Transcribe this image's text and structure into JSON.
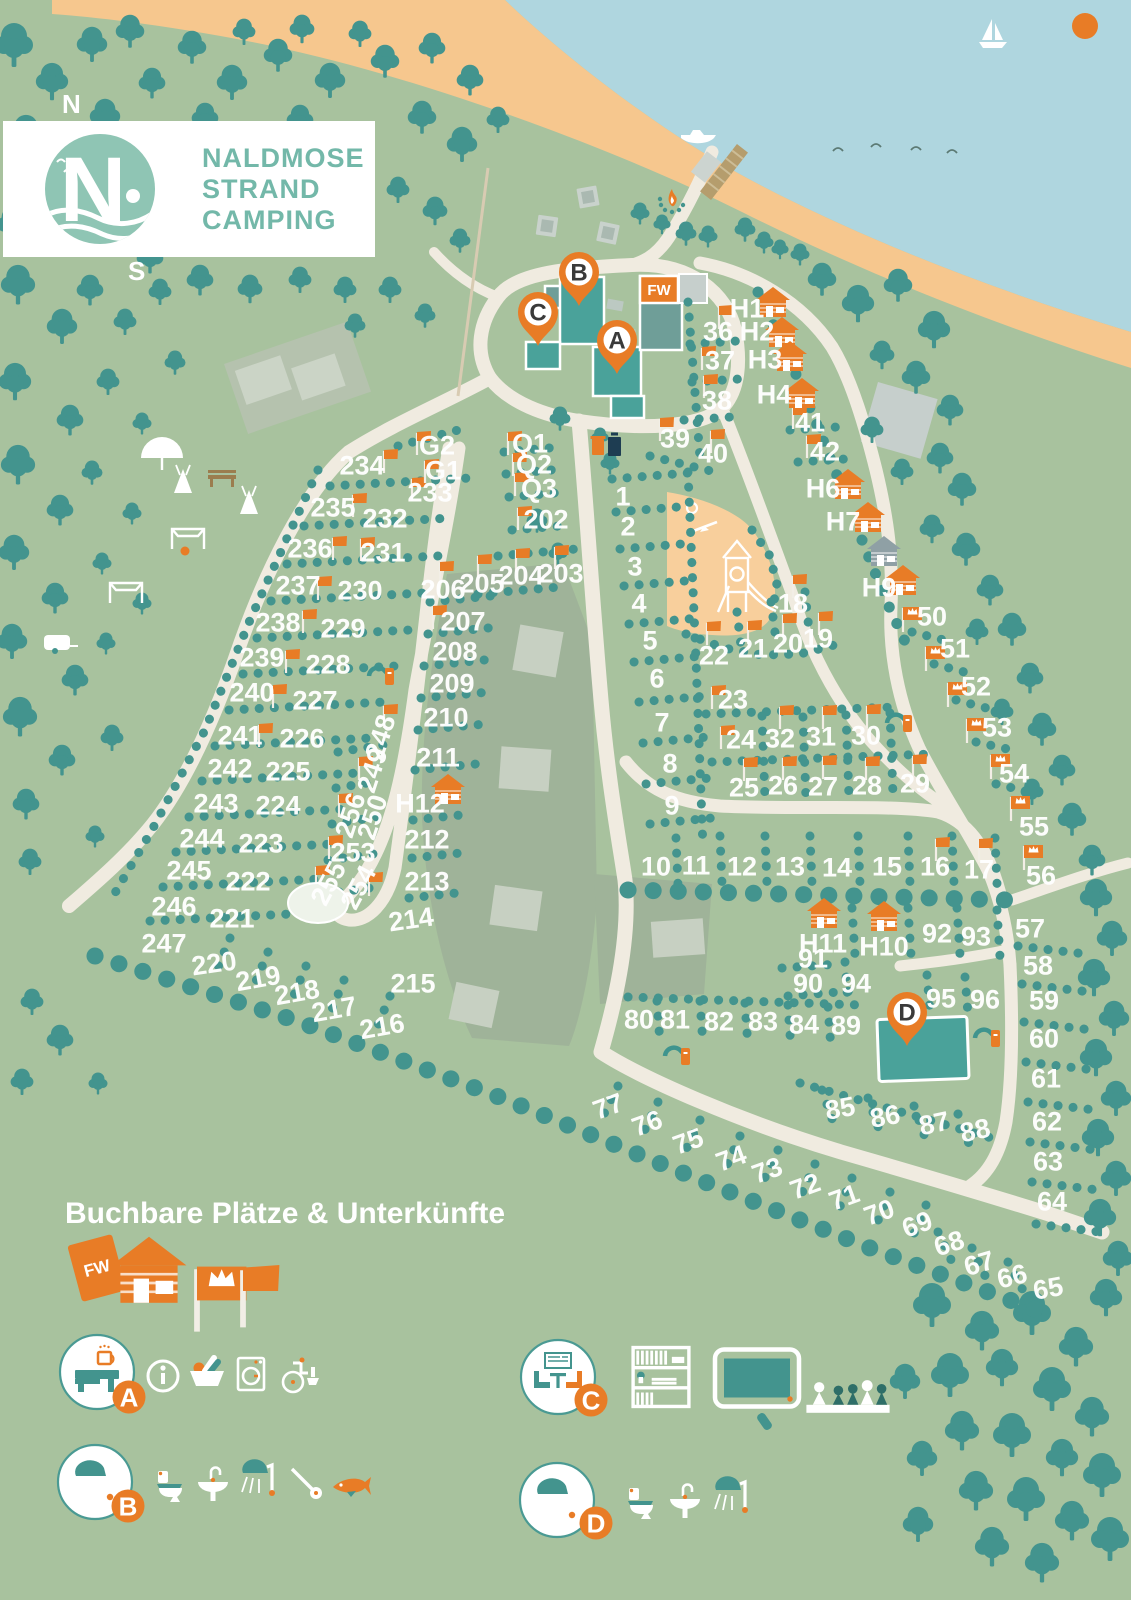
{
  "logo": {
    "initial": "N",
    "line1": "NALDMOSE",
    "line2": "STRAND",
    "line3": "CAMPING"
  },
  "compass": {
    "n": "N",
    "w": "W",
    "s": "S",
    "e": "O"
  },
  "colors": {
    "land": "#a8c29e",
    "water": "#afd6df",
    "sand": "#f6c78e",
    "tree": "#43948e",
    "path": "#f0ebe0",
    "accent": "#e87c26",
    "building": "#4aa29a",
    "building_muted": "#6f9e98",
    "field": "#9fb399",
    "field_light": "#c7d0c2",
    "gray": "#c6cfcc",
    "playground": "#f8cf9c",
    "label": "#ffffff",
    "logo_teal": "#73b8a9",
    "navy": "#1e3d52"
  },
  "legend": {
    "title": "Buchbare Plätze & Unterkünfte",
    "items": [
      {
        "id": "holiday-apartment",
        "label": "FW"
      },
      {
        "id": "cabin"
      },
      {
        "id": "comfort-pitch-flag"
      },
      {
        "id": "standard-pitch-flag"
      }
    ]
  },
  "facilities": [
    {
      "id": "A",
      "circle": "reception",
      "items": [
        "info",
        "shop-basket",
        "washing-machine",
        "accessible-wc"
      ]
    },
    {
      "id": "B",
      "circle": "shower",
      "items": [
        "wc",
        "sink",
        "shower",
        "hairdryer",
        "fish-cleaning"
      ]
    },
    {
      "id": "C",
      "circle": "lounge",
      "items": [
        "bookshelf",
        "tv",
        "board-games"
      ]
    },
    {
      "id": "D",
      "circle": "shower",
      "items": [
        "wc",
        "sink",
        "shower"
      ]
    }
  ],
  "map": {
    "fw_label": "FW",
    "pins": [
      {
        "id": "A",
        "x": 617,
        "y": 374
      },
      {
        "id": "B",
        "x": 579,
        "y": 306
      },
      {
        "id": "C",
        "x": 538,
        "y": 346
      },
      {
        "id": "D",
        "x": 907,
        "y": 1046
      }
    ],
    "plots": [
      [
        "1",
        623,
        496
      ],
      [
        "2",
        628,
        526
      ],
      [
        "3",
        635,
        566
      ],
      [
        "4",
        639,
        603
      ],
      [
        "5",
        650,
        640
      ],
      [
        "6",
        657,
        678
      ],
      [
        "7",
        662,
        722
      ],
      [
        "8",
        670,
        763
      ],
      [
        "9",
        672,
        805
      ],
      [
        "10",
        656,
        866
      ],
      [
        "11",
        696,
        865
      ],
      [
        "12",
        742,
        866
      ],
      [
        "13",
        790,
        866
      ],
      [
        "14",
        837,
        867
      ],
      [
        "15",
        887,
        866
      ],
      [
        "16",
        935,
        866
      ],
      [
        "17",
        979,
        869
      ],
      [
        "18",
        793,
        603
      ],
      [
        "19",
        818,
        638
      ],
      [
        "20",
        788,
        643
      ],
      [
        "21",
        753,
        648
      ],
      [
        "22",
        714,
        655
      ],
      [
        "23",
        733,
        699
      ],
      [
        "24",
        741,
        739
      ],
      [
        "25",
        744,
        787
      ],
      [
        "26",
        783,
        785
      ],
      [
        "27",
        823,
        786
      ],
      [
        "28",
        867,
        785
      ],
      [
        "29",
        915,
        783
      ],
      [
        "30",
        866,
        735
      ],
      [
        "31",
        821,
        736
      ],
      [
        "32",
        780,
        738
      ],
      [
        "36",
        718,
        331
      ],
      [
        "37",
        720,
        360
      ],
      [
        "38",
        717,
        400
      ],
      [
        "39",
        675,
        438
      ],
      [
        "40",
        713,
        453
      ],
      [
        "41",
        810,
        422
      ],
      [
        "42",
        825,
        451
      ],
      [
        "50",
        932,
        616
      ],
      [
        "51",
        955,
        648
      ],
      [
        "52",
        976,
        686
      ],
      [
        "53",
        997,
        727
      ],
      [
        "54",
        1014,
        773
      ],
      [
        "55",
        1034,
        826
      ],
      [
        "56",
        1041,
        875
      ],
      [
        "57",
        1030,
        928
      ],
      [
        "58",
        1038,
        965
      ],
      [
        "59",
        1044,
        1000
      ],
      [
        "60",
        1044,
        1038
      ],
      [
        "61",
        1046,
        1078
      ],
      [
        "62",
        1047,
        1121
      ],
      [
        "63",
        1048,
        1161
      ],
      [
        "64",
        1052,
        1201
      ],
      [
        "65",
        1048,
        1288,
        -10
      ],
      [
        "66",
        1012,
        1276,
        -14
      ],
      [
        "67",
        979,
        1263,
        -16
      ],
      [
        "68",
        949,
        1243,
        -18
      ],
      [
        "69",
        917,
        1224,
        -20
      ],
      [
        "70",
        879,
        1212,
        -20
      ],
      [
        "71",
        844,
        1197,
        -20
      ],
      [
        "72",
        805,
        1186,
        -20
      ],
      [
        "73",
        767,
        1170,
        -20
      ],
      [
        "74",
        731,
        1158,
        -20
      ],
      [
        "75",
        688,
        1141,
        -20
      ],
      [
        "76",
        647,
        1123,
        -20
      ],
      [
        "77",
        608,
        1106,
        -20
      ],
      [
        "80",
        639,
        1019
      ],
      [
        "81",
        675,
        1019
      ],
      [
        "82",
        719,
        1021
      ],
      [
        "83",
        763,
        1021
      ],
      [
        "84",
        804,
        1024
      ],
      [
        "89",
        846,
        1025
      ],
      [
        "85",
        840,
        1108,
        -10
      ],
      [
        "86",
        885,
        1116,
        -10
      ],
      [
        "87",
        934,
        1123,
        -12
      ],
      [
        "88",
        975,
        1130,
        -12
      ],
      [
        "90",
        808,
        983
      ],
      [
        "91",
        813,
        958
      ],
      [
        "92",
        937,
        933
      ],
      [
        "93",
        976,
        936
      ],
      [
        "94",
        856,
        983
      ],
      [
        "95",
        941,
        998
      ],
      [
        "96",
        985,
        999
      ],
      [
        "202",
        546,
        519
      ],
      [
        "203",
        561,
        573
      ],
      [
        "204",
        521,
        575
      ],
      [
        "205",
        482,
        583
      ],
      [
        "206",
        443,
        589
      ],
      [
        "207",
        463,
        621
      ],
      [
        "208",
        455,
        651
      ],
      [
        "209",
        452,
        683
      ],
      [
        "210",
        446,
        717
      ],
      [
        "211",
        438,
        757
      ],
      [
        "212",
        427,
        839
      ],
      [
        "213",
        427,
        881
      ],
      [
        "214",
        411,
        919,
        -8
      ],
      [
        "215",
        413,
        983
      ],
      [
        "216",
        382,
        1026,
        -10
      ],
      [
        "217",
        334,
        1009,
        -10
      ],
      [
        "218",
        297,
        992,
        -10
      ],
      [
        "219",
        258,
        978,
        -10
      ],
      [
        "220",
        214,
        963,
        -8
      ],
      [
        "221",
        232,
        918
      ],
      [
        "222",
        248,
        881
      ],
      [
        "223",
        261,
        843
      ],
      [
        "224",
        278,
        805
      ],
      [
        "225",
        288,
        771
      ],
      [
        "226",
        302,
        738
      ],
      [
        "227",
        315,
        700
      ],
      [
        "228",
        328,
        664
      ],
      [
        "229",
        343,
        628
      ],
      [
        "230",
        360,
        590
      ],
      [
        "231",
        383,
        552
      ],
      [
        "232",
        385,
        518
      ],
      [
        "233",
        430,
        492
      ],
      [
        "234",
        362,
        465
      ],
      [
        "235",
        333,
        507
      ],
      [
        "236",
        310,
        548
      ],
      [
        "237",
        298,
        585
      ],
      [
        "238",
        278,
        622
      ],
      [
        "239",
        262,
        657
      ],
      [
        "240",
        252,
        692
      ],
      [
        "241",
        240,
        735
      ],
      [
        "242",
        230,
        768
      ],
      [
        "243",
        216,
        803
      ],
      [
        "244",
        202,
        838
      ],
      [
        "245",
        189,
        870
      ],
      [
        "246",
        174,
        906
      ],
      [
        "247",
        164,
        943
      ],
      [
        "248",
        380,
        737,
        -72
      ],
      [
        "249",
        372,
        770,
        -72
      ],
      [
        "250",
        372,
        817,
        -72
      ],
      [
        "253",
        353,
        852
      ],
      [
        "254",
        358,
        887,
        -62
      ],
      [
        "255",
        328,
        883,
        -62
      ],
      [
        "256",
        350,
        815,
        -72
      ],
      [
        "G1",
        443,
        470
      ],
      [
        "G2",
        437,
        445
      ],
      [
        "Q1",
        530,
        443
      ],
      [
        "Q2",
        534,
        464
      ],
      [
        "Q3",
        539,
        488
      ]
    ],
    "cabins": [
      {
        "t": "H1",
        "cx": 773,
        "cy": 303,
        "lx": 747,
        "ly": 308
      },
      {
        "t": "H2",
        "cx": 782,
        "cy": 333,
        "lx": 757,
        "ly": 331
      },
      {
        "t": "H3",
        "cx": 790,
        "cy": 357,
        "lx": 765,
        "ly": 359
      },
      {
        "t": "H4",
        "cx": 802,
        "cy": 394,
        "lx": 774,
        "ly": 394
      },
      {
        "t": "H6",
        "cx": 848,
        "cy": 485,
        "lx": 823,
        "ly": 488
      },
      {
        "t": "H7",
        "cx": 868,
        "cy": 518,
        "lx": 843,
        "ly": 521
      },
      {
        "t": "",
        "cx": 884,
        "cy": 552,
        "gray": true
      },
      {
        "t": "H9",
        "cx": 903,
        "cy": 581,
        "lx": 879,
        "ly": 587
      },
      {
        "t": "H10",
        "cx": 884,
        "cy": 917,
        "lx": 884,
        "ly": 946
      },
      {
        "t": "H11",
        "cx": 824,
        "cy": 914,
        "lx": 823,
        "ly": 943
      },
      {
        "t": "H12",
        "cx": 448,
        "cy": 790,
        "lx": 420,
        "ly": 803
      }
    ],
    "flags": [
      [
        384,
        459
      ],
      [
        412,
        487
      ],
      [
        353,
        503
      ],
      [
        361,
        547
      ],
      [
        333,
        546
      ],
      [
        318,
        586
      ],
      [
        303,
        619
      ],
      [
        286,
        659
      ],
      [
        273,
        694
      ],
      [
        259,
        733
      ],
      [
        508,
        441
      ],
      [
        513,
        462
      ],
      [
        515,
        482
      ],
      [
        518,
        516
      ],
      [
        516,
        558
      ],
      [
        555,
        555
      ],
      [
        478,
        564
      ],
      [
        440,
        571
      ],
      [
        433,
        615
      ],
      [
        417,
        441
      ],
      [
        425,
        469
      ],
      [
        707,
        631
      ],
      [
        748,
        630
      ],
      [
        783,
        623
      ],
      [
        819,
        621
      ],
      [
        793,
        584
      ],
      [
        712,
        695
      ],
      [
        721,
        735
      ],
      [
        744,
        767
      ],
      [
        783,
        766
      ],
      [
        823,
        765
      ],
      [
        866,
        766
      ],
      [
        913,
        764
      ],
      [
        867,
        714
      ],
      [
        823,
        715
      ],
      [
        780,
        715
      ],
      [
        936,
        847
      ],
      [
        979,
        848
      ],
      [
        702,
        356
      ],
      [
        704,
        384
      ],
      [
        660,
        427
      ],
      [
        711,
        439
      ],
      [
        793,
        415
      ],
      [
        807,
        444
      ],
      [
        359,
        766
      ],
      [
        339,
        803
      ],
      [
        329,
        845
      ],
      [
        316,
        875
      ],
      [
        369,
        882
      ],
      [
        384,
        714
      ],
      [
        719,
        315
      ]
    ],
    "crown_flags": [
      [
        903,
        616
      ],
      [
        926,
        655
      ],
      [
        948,
        691
      ],
      [
        967,
        727
      ],
      [
        991,
        763
      ],
      [
        1011,
        805
      ],
      [
        1024,
        854
      ]
    ],
    "features": [
      {
        "type": "picnic-table",
        "x": 588,
        "y": 197,
        "r": -10
      },
      {
        "type": "picnic-table",
        "x": 547,
        "y": 226,
        "r": 8
      },
      {
        "type": "picnic-table",
        "x": 608,
        "y": 233,
        "r": 12
      },
      {
        "type": "campfire",
        "x": 672,
        "y": 202
      },
      {
        "type": "waste-bins",
        "x": 608,
        "y": 452
      },
      {
        "type": "water-tap",
        "x": 380,
        "y": 676
      },
      {
        "type": "water-tap",
        "x": 898,
        "y": 723
      },
      {
        "type": "water-tap",
        "x": 676,
        "y": 1056
      },
      {
        "type": "water-tap",
        "x": 986,
        "y": 1038
      },
      {
        "type": "tipi",
        "x": 183,
        "y": 482
      },
      {
        "type": "tipi",
        "x": 249,
        "y": 503
      },
      {
        "type": "umbrella",
        "x": 162,
        "y": 456
      },
      {
        "type": "bench",
        "x": 222,
        "y": 478
      },
      {
        "type": "soccer-goal",
        "x": 188,
        "y": 538
      },
      {
        "type": "soccer-goal",
        "x": 126,
        "y": 592
      },
      {
        "type": "ball",
        "x": 185,
        "y": 551
      },
      {
        "type": "trampoline",
        "x": 318,
        "y": 903
      },
      {
        "type": "caravan",
        "x": 57,
        "y": 644
      },
      {
        "type": "motorboat",
        "x": 698,
        "y": 136
      },
      {
        "type": "sailboat",
        "x": 993,
        "y": 36
      },
      {
        "type": "sun",
        "x": 1085,
        "y": 26
      },
      {
        "type": "bird",
        "x": 838,
        "y": 151
      },
      {
        "type": "bird",
        "x": 876,
        "y": 147
      },
      {
        "type": "bird",
        "x": 916,
        "y": 150
      },
      {
        "type": "bird",
        "x": 952,
        "y": 153
      }
    ]
  }
}
